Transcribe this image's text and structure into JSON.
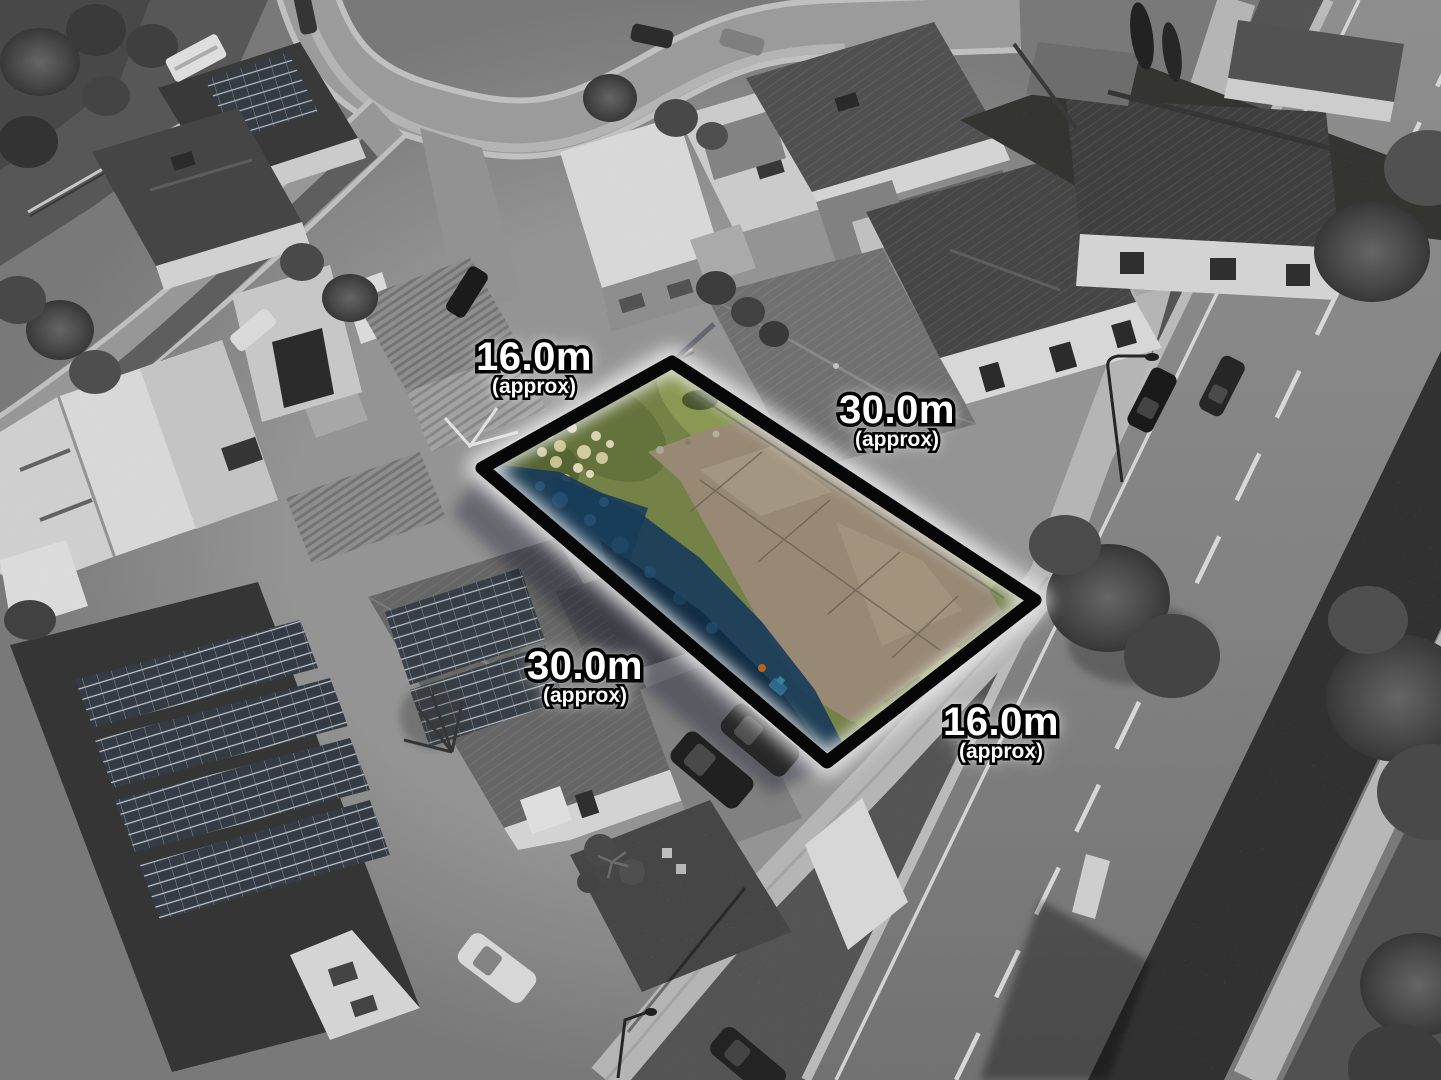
{
  "annotations": {
    "frontage_top": {
      "value": "16.0m",
      "qualifier": "(approx)"
    },
    "depth_right": {
      "value": "30.0m",
      "qualifier": "(approx)"
    },
    "depth_left": {
      "value": "30.0m",
      "qualifier": "(approx)"
    },
    "frontage_bottom": {
      "value": "16.0m",
      "qualifier": "(approx)"
    }
  },
  "colors": {
    "boundary_line": "#080808",
    "boundary_glow": "#ffffff",
    "label_text": "#ffffff",
    "label_outline": "#000000",
    "lot_grass_green": "#7e8d4e",
    "lot_concrete_tan": "#a4957e",
    "lot_shadow_blue": "#1b4161",
    "lot_flowers_cream": "#ece5c3"
  }
}
